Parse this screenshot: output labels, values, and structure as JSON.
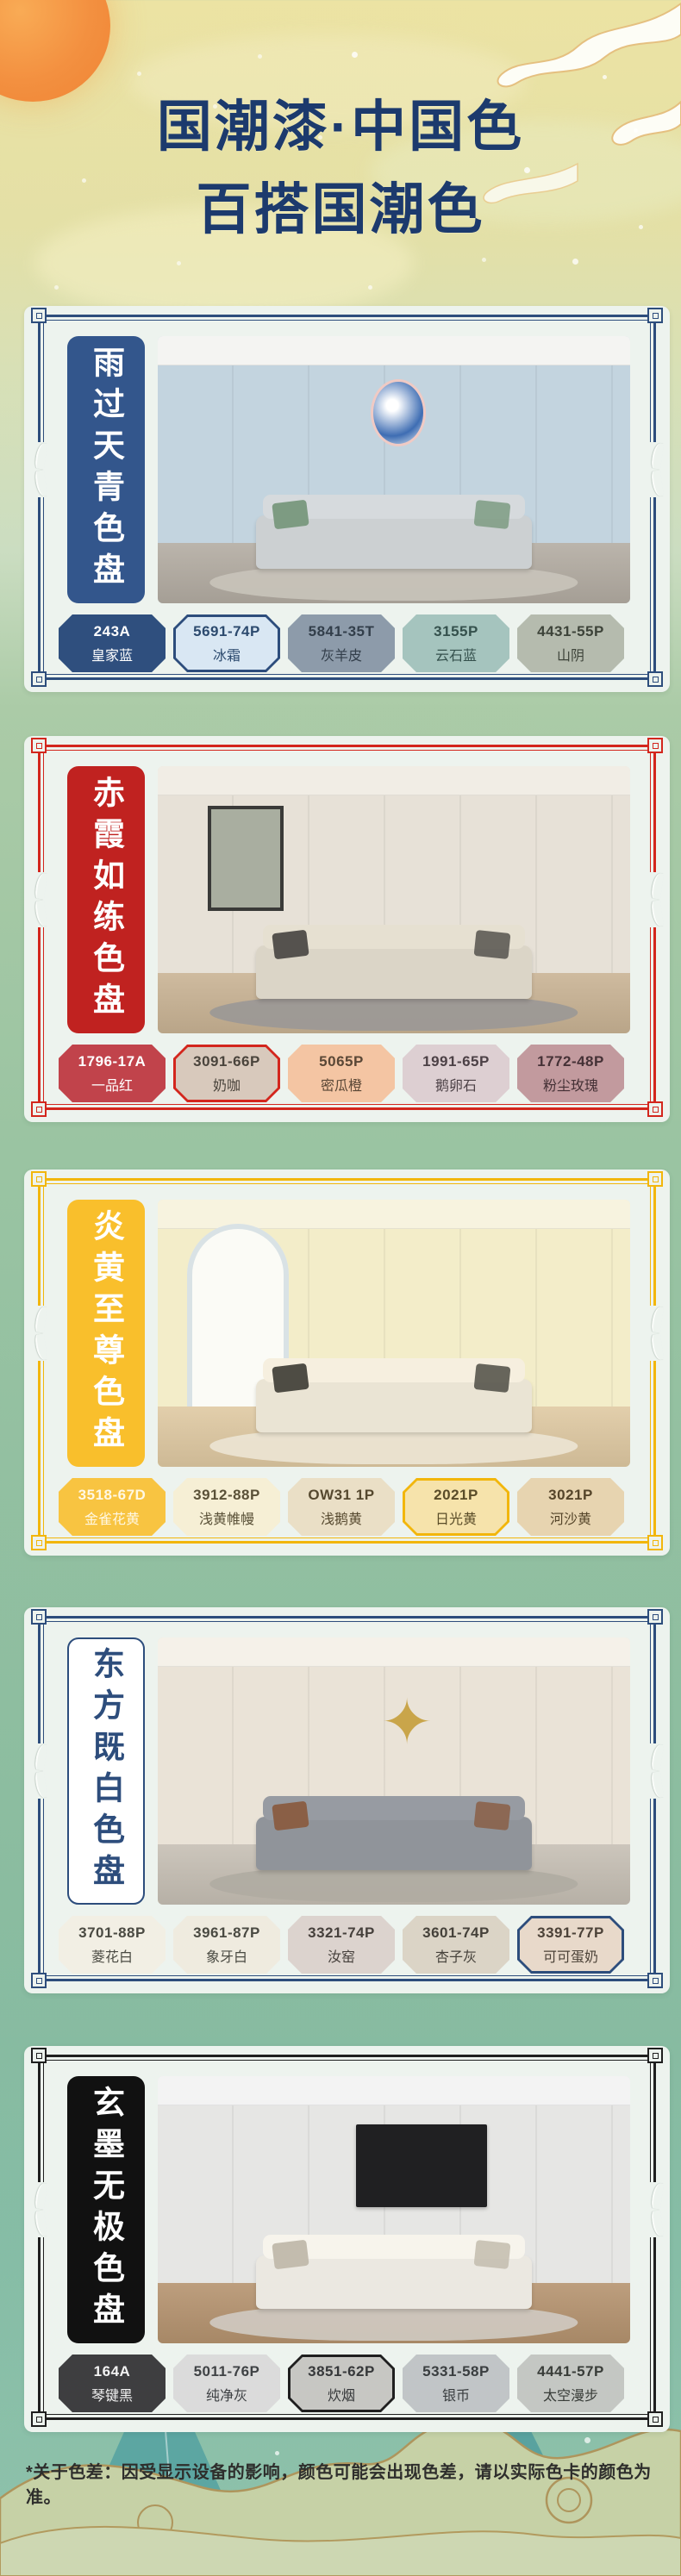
{
  "header": {
    "line1": "国潮漆·中国色",
    "line2": "百搭国潮色",
    "text_color": "#1c3a6d"
  },
  "footer": {
    "note": "*关于色差：因受显示设备的影响，颜色可能会出现色差，请以实际色卡的颜色为准。"
  },
  "palettes": [
    {
      "title": "雨过天青色盘",
      "frame_color": "#2d4d7c",
      "banner": {
        "bg": "#33568c",
        "text_color": "#ffffff",
        "bordered": false
      },
      "room": {
        "ceiling": "#f4f4f2",
        "wall": "#c3d4df",
        "floor": "#b3aca2",
        "rug": "#c8c3ba",
        "sofa": "#ccd0d2",
        "pillow": "#7d9b82",
        "art_type": "circle",
        "art_color": "#3e6db3"
      },
      "swatches": [
        {
          "code": "243A",
          "name": "皇家蓝",
          "fill": "#2f4f7e",
          "text": "#ffffff",
          "selected": false
        },
        {
          "code": "5691-74P",
          "name": "冰霜",
          "fill": "#d9e7f3",
          "text": "#2c4a6e",
          "selected": true
        },
        {
          "code": "5841-35T",
          "name": "灰羊皮",
          "fill": "#8d9baa",
          "text": "#323e4a",
          "selected": false
        },
        {
          "code": "3155P",
          "name": "云石蓝",
          "fill": "#a5c4be",
          "text": "#35514d",
          "selected": false
        },
        {
          "code": "4431-55P",
          "name": "山阴",
          "fill": "#b5bbae",
          "text": "#3d4339",
          "selected": false
        }
      ]
    },
    {
      "title": "赤霞如练色盘",
      "frame_color": "#d3261d",
      "banner": {
        "bg": "#c02220",
        "text_color": "#ffffff",
        "bordered": false
      },
      "room": {
        "ceiling": "#f1ede5",
        "wall": "#e7e1d7",
        "floor": "#c9b394",
        "rug": "#9b9896",
        "sofa": "#dbd5c7",
        "pillow": "#55524e",
        "art_type": "painting",
        "art_color": "#a9aea0"
      },
      "swatches": [
        {
          "code": "1796-17A",
          "name": "一品红",
          "fill": "#c1434b",
          "text": "#ffffff",
          "selected": false
        },
        {
          "code": "3091-66P",
          "name": "奶咖",
          "fill": "#d8c9bc",
          "text": "#4a443c",
          "selected": true
        },
        {
          "code": "5065P",
          "name": "密瓜橙",
          "fill": "#f4c5a3",
          "text": "#5a4736",
          "selected": false
        },
        {
          "code": "1991-65P",
          "name": "鹅卵石",
          "fill": "#ddcfd2",
          "text": "#4c4146",
          "selected": false
        },
        {
          "code": "1772-48P",
          "name": "粉尘玫瑰",
          "fill": "#c29a9e",
          "text": "#453136",
          "selected": false
        }
      ]
    },
    {
      "title": "炎黄至尊色盘",
      "frame_color": "#f2b60c",
      "banner": {
        "bg": "#f9bf2c",
        "text_color": "#ffffff",
        "bordered": false
      },
      "room": {
        "ceiling": "#f7f3df",
        "wall": "#f3edc9",
        "floor": "#dfc9a2",
        "rug": "#ece4d2",
        "sofa": "#eae4d4",
        "pillow": "#4e4c44",
        "art_type": "arch",
        "art_color": "#fbfbf6"
      },
      "swatches": [
        {
          "code": "3518-67D",
          "name": "金雀花黄",
          "fill": "#f8c441",
          "text": "#fff8e4",
          "selected": false
        },
        {
          "code": "3912-88P",
          "name": "浅黄帷幔",
          "fill": "#f6efd5",
          "text": "#5a5138",
          "selected": false
        },
        {
          "code": "OW31 1P",
          "name": "浅鹅黄",
          "fill": "#eadfc6",
          "text": "#56492f",
          "selected": false
        },
        {
          "code": "2021P",
          "name": "日光黄",
          "fill": "#f6e3ab",
          "text": "#5a4c28",
          "selected": true
        },
        {
          "code": "3021P",
          "name": "河沙黄",
          "fill": "#e7d4b0",
          "text": "#55452a",
          "selected": false
        }
      ]
    },
    {
      "title": "东方既白色盘",
      "frame_color": "#2d4d7c",
      "banner": {
        "bg": "#ffffff",
        "text_color": "#2d4d7c",
        "bordered": true
      },
      "room": {
        "ceiling": "#f5f1e9",
        "wall": "#eae3d7",
        "floor": "#c6bfb4",
        "rug": "#b0aba2",
        "sofa": "#90949a",
        "pillow": "#8a5f46",
        "art_type": "star",
        "art_color": "#c9a54a"
      },
      "swatches": [
        {
          "code": "3701-88P",
          "name": "菱花白",
          "fill": "#f2efe4",
          "text": "#4a4a42",
          "selected": false
        },
        {
          "code": "3961-87P",
          "name": "象牙白",
          "fill": "#efebdf",
          "text": "#4a4a42",
          "selected": false
        },
        {
          "code": "3321-74P",
          "name": "汝窑",
          "fill": "#dcd3ce",
          "text": "#46403c",
          "selected": false
        },
        {
          "code": "3601-74P",
          "name": "杏子灰",
          "fill": "#dbd4c6",
          "text": "#45413a",
          "selected": false
        },
        {
          "code": "3391-77P",
          "name": "可可蛋奶",
          "fill": "#e8d9ca",
          "text": "#4c4238",
          "selected": true
        }
      ]
    },
    {
      "title": "玄墨无极色盘",
      "frame_color": "#1f1f1f",
      "banner": {
        "bg": "#111111",
        "text_color": "#ffffff",
        "bordered": false
      },
      "room": {
        "ceiling": "#f3f3f3",
        "wall": "#e6e6e4",
        "floor": "#b5936f",
        "rug": "#cfc9c0",
        "sofa": "#ebe8e1",
        "pillow": "#c3bcae",
        "art_type": "tv",
        "art_color": "#202022"
      },
      "swatches": [
        {
          "code": "164A",
          "name": "琴键黑",
          "fill": "#3e3e40",
          "text": "#f2f2f2",
          "selected": false
        },
        {
          "code": "5011-76P",
          "name": "纯净灰",
          "fill": "#dbdbdb",
          "text": "#3f4245",
          "selected": false
        },
        {
          "code": "3851-62P",
          "name": "炊烟",
          "fill": "#c7c7c3",
          "text": "#36383a",
          "selected": true
        },
        {
          "code": "5331-58P",
          "name": "银币",
          "fill": "#c1c5c7",
          "text": "#3a3e40",
          "selected": false
        },
        {
          "code": "4441-57P",
          "name": "太空漫步",
          "fill": "#c4c7c3",
          "text": "#393d39",
          "selected": false
        }
      ]
    }
  ]
}
